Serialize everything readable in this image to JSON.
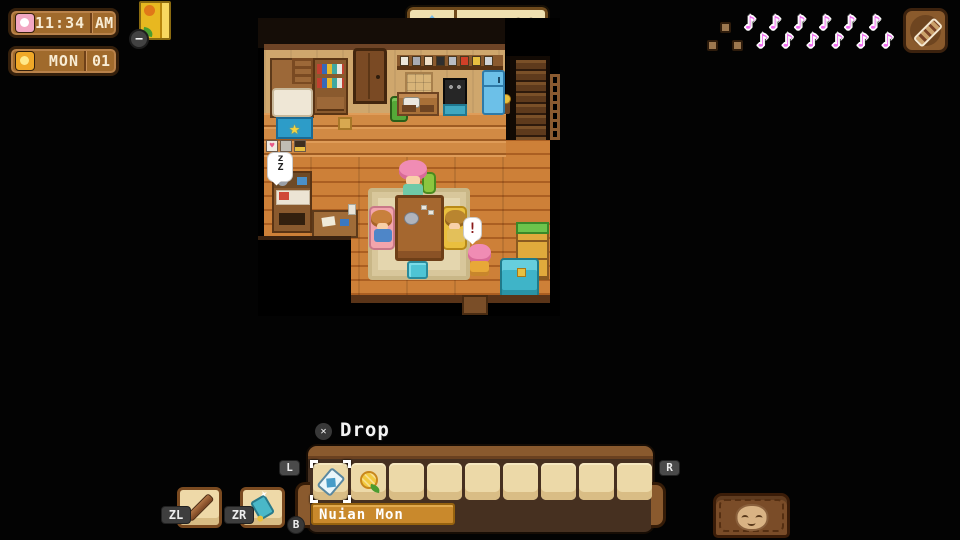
{
  "hud": {
    "clock": {
      "time": "11:34",
      "meridiem": "AM",
      "day": "MON",
      "date": "01"
    },
    "journal_badge": "−",
    "currency": {
      "amount": "20",
      "icon": "gem-icon"
    },
    "melody_meter": {
      "filled": 12,
      "empty": 3,
      "sequence": [
        "empty",
        "empty",
        "empty",
        "note",
        "note",
        "note",
        "note",
        "note",
        "note",
        "note",
        "note",
        "note",
        "note",
        "note",
        "note"
      ]
    },
    "instrument_button": {
      "icon": "harmonica-icon"
    }
  },
  "scene": {
    "sleep_bubble": "zZ",
    "alert_bubble": "!"
  },
  "hotbar": {
    "action_hint": {
      "button_glyph": "✕",
      "label": "Drop"
    },
    "shoulder_left": "L",
    "shoulder_right": "R",
    "back_button": "B",
    "trigger_left": {
      "label": "ZL",
      "icon": "stick-icon"
    },
    "trigger_right": {
      "label": "ZR",
      "icon": "net-icon"
    },
    "tooltip": "Nuian Mon",
    "selected_index": 0,
    "slots": [
      {
        "icon": "card-icon"
      },
      {
        "icon": "fruit-icon"
      },
      null,
      null,
      null,
      null,
      null,
      null,
      null
    ]
  },
  "colors": {
    "background": "#030303",
    "hud_brown": "#a06a2c",
    "money_cream": "#efe0b0",
    "note_pink": "#f26df2",
    "hotbar_brown": "#463020",
    "slot_cream": "#ecd9a8",
    "tooltip_orange": "#c9892c",
    "floor_orange": "#cd8038",
    "wall_tan": "#cfa76d"
  }
}
